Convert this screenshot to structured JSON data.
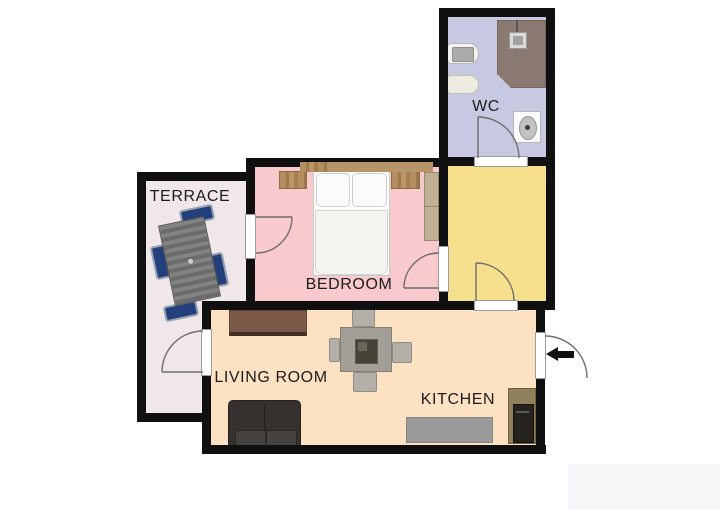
{
  "plan": {
    "type": "apartment-floor-plan",
    "rooms": {
      "wc": {
        "label": "WC"
      },
      "terrace": {
        "label": "TERRACE"
      },
      "bedroom": {
        "label": "BEDROOM"
      },
      "living_room": {
        "label": "LIVING ROOM"
      },
      "kitchen": {
        "label": "KITCHEN"
      },
      "hallway": {
        "label": ""
      }
    },
    "icons": {
      "entrance_arrow": "left-arrow"
    },
    "colors": {
      "wall": "#101010",
      "wc_floor": "#c7c8e1",
      "hall_floor": "#f7e08d",
      "bedroom_floor": "#f8c9cd",
      "terrace_floor": "#f0e7ea",
      "living_floor": "#fce1c2",
      "shower": "#8b7a72",
      "wood": "#b28e60",
      "terrace_chair": "#24407c",
      "sofa": "#35312f",
      "sideboard": "#7b5a49",
      "counter": "#9b9b9b",
      "kitchen_unit": "#91805e",
      "appliance": "#26231f",
      "door_line": "#6e6e6e",
      "watermark": "#f7f7fa"
    }
  }
}
